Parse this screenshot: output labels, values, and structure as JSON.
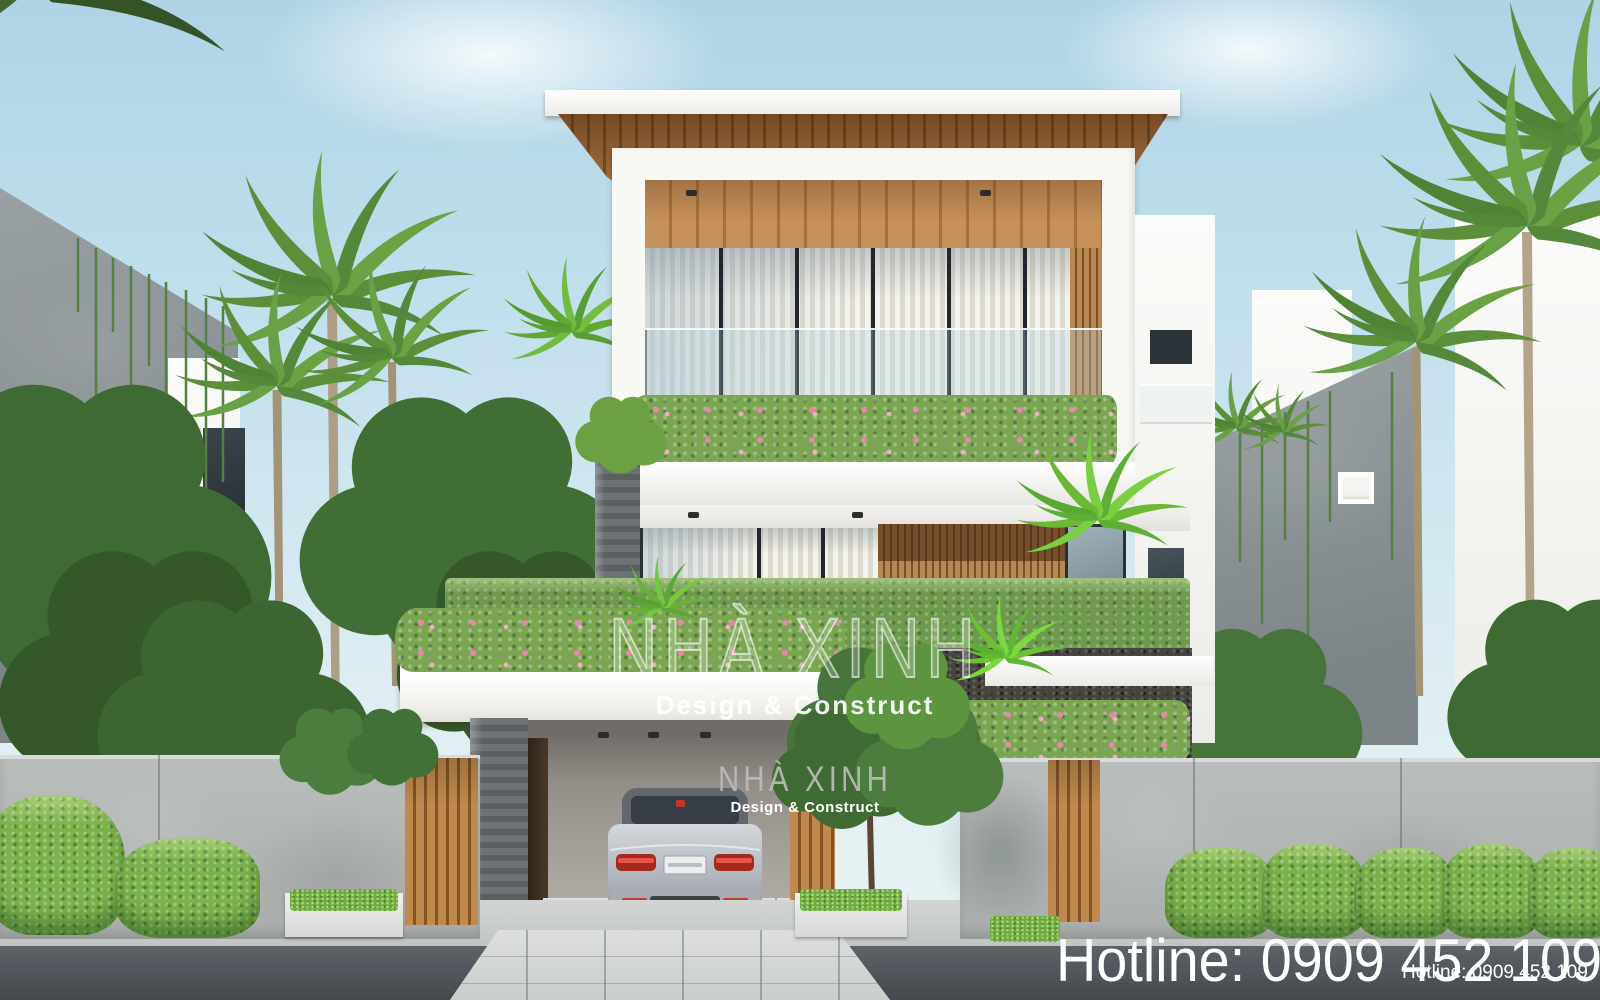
{
  "scene": {
    "title": "Modern villa exterior render",
    "description": "Three-storey white modern house with wood accents, balcony flower planter, vertical-garden hedge wall, carport with silver sedan, concrete fence with timber-slat gates and tropical palms on both sides"
  },
  "watermark_center": {
    "brand": "NHÀ XINH",
    "tagline": "Design & Construct"
  },
  "watermark_small": {
    "brand": "NHÀ XINH",
    "tagline": "Design & Construct"
  },
  "hotline_large": {
    "label": "Hotline: 0909 452 109"
  },
  "hotline_small": {
    "label": "Hotline: 0909 452 109"
  },
  "palette": {
    "sky_top": "#afd4e6",
    "sky_horizon": "#eaf4f3",
    "white_wall": "#f6f6f3",
    "wood": "#a06b3a",
    "wood_dark": "#7a4e2a",
    "hedge_green": "#6e9a4d",
    "shrub_green": "#7cb24a",
    "flower_pink": "#e687ab",
    "concrete_fence": "#b9bdbb",
    "concrete_dark": "#7d8487",
    "stone_dark": "#45443e",
    "car_silver": "#b9bec5",
    "tail_light_red": "#c0392b",
    "asphalt": "#4e545a",
    "watermark_white": "#ffffff",
    "watermark_gray": "#bbb9b5",
    "hotline_color": "#ffffff"
  }
}
